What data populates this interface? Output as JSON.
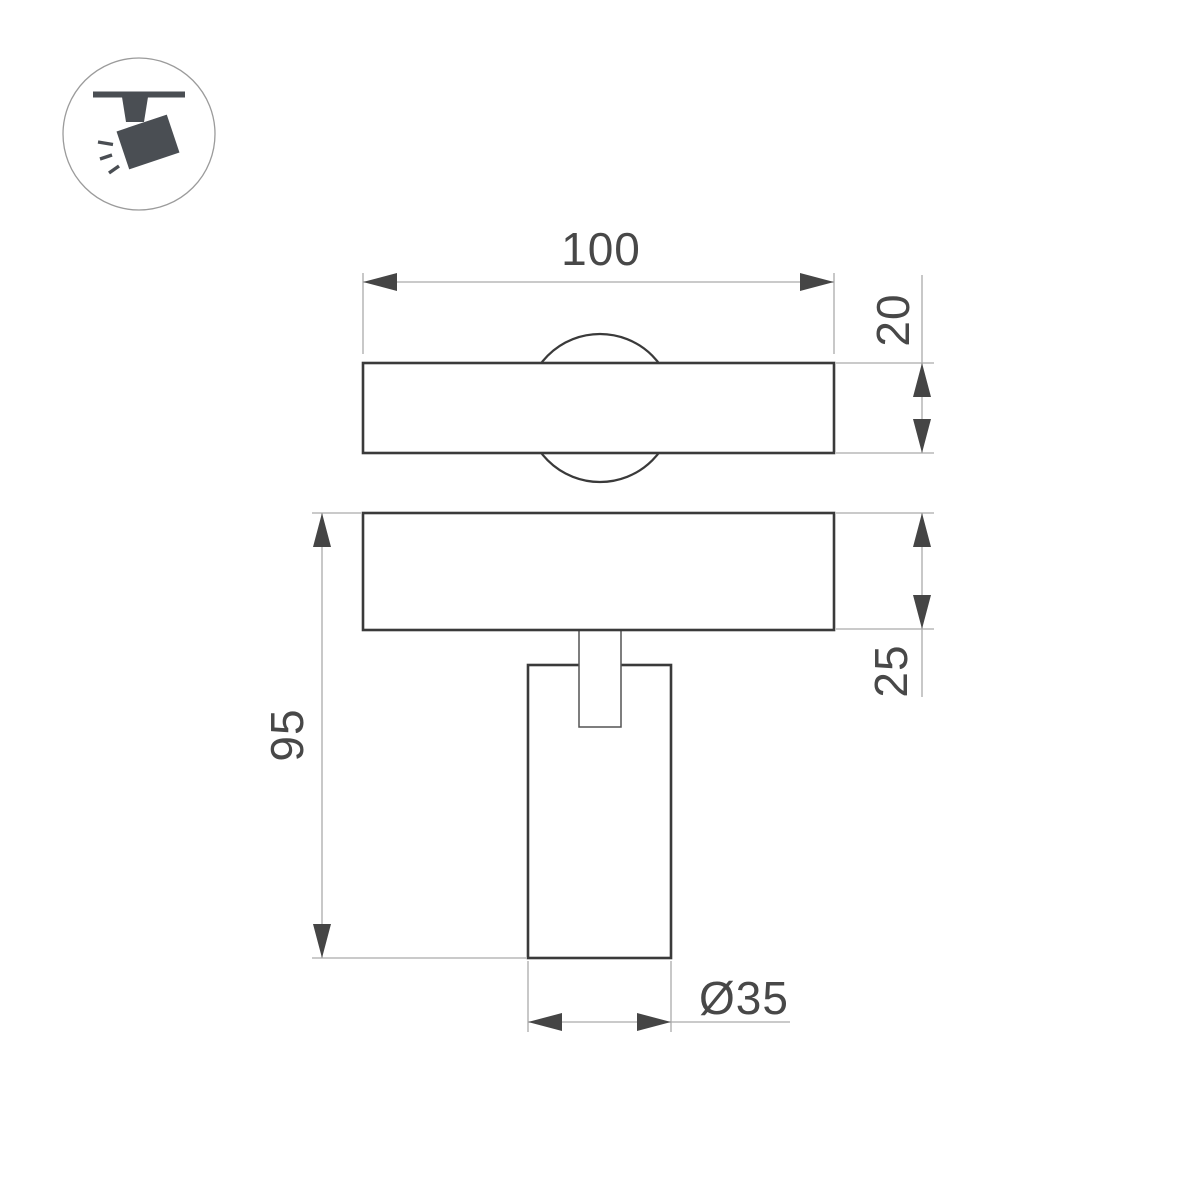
{
  "page": {
    "background": "#ffffff"
  },
  "logo": {
    "icon": "track-spotlight-icon",
    "ring_color": "#9b9b9b",
    "glyph_color": "#4a4e53"
  },
  "drawing": {
    "type": "technical-dimension-drawing",
    "colors": {
      "object_line": "#3a3a3a",
      "thin_line": "#ababab",
      "dimension_text": "#484848"
    },
    "dimensions": {
      "overall_width": "100",
      "plate_thickness": "20",
      "plate_height": "25",
      "overall_height": "95",
      "body_diameter": "Ø35"
    }
  }
}
